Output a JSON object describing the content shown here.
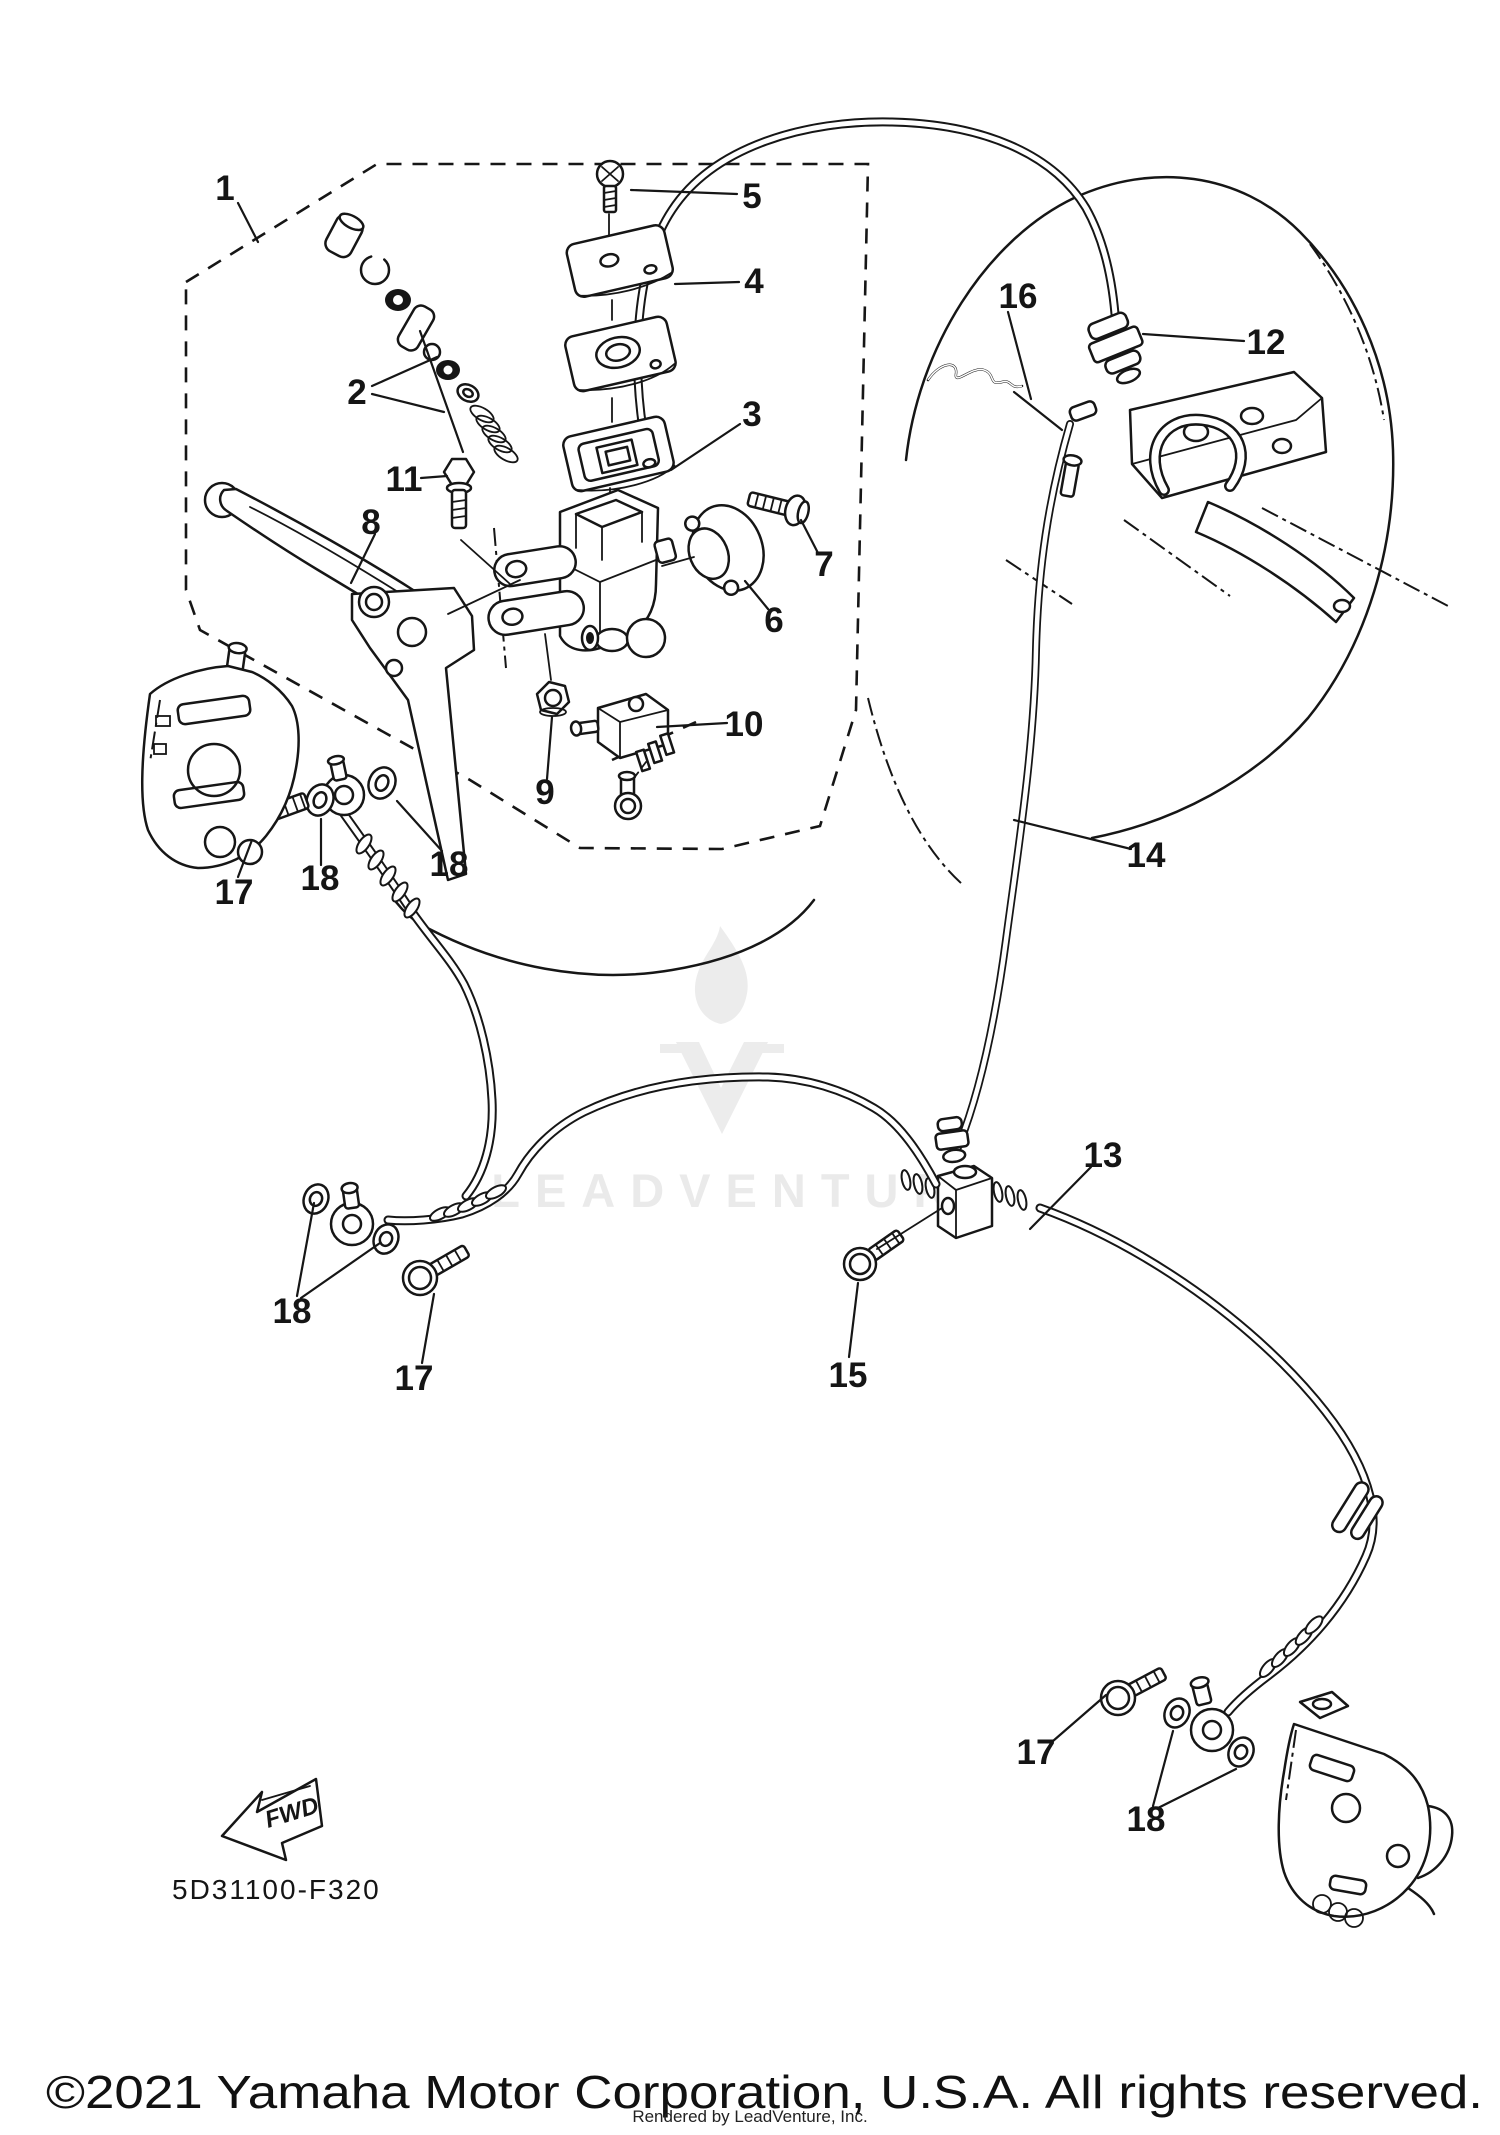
{
  "page": {
    "background": "#ffffff",
    "line_color": "#161616",
    "watermark_color": "#eaeaea"
  },
  "document": {
    "part_code": "5D31100-F320",
    "copyright": "©2021 Yamaha Motor Corporation, U.S.A. All rights reserved.",
    "rendered_by": "Rendered by LeadVenture, Inc.",
    "fwd_label": "FWD",
    "watermark_text": "LEADVENTURE"
  },
  "diagram": {
    "callouts": [
      {
        "id": "callout-1",
        "label": "1",
        "x": 225,
        "y": 200
      },
      {
        "id": "callout-2",
        "label": "2",
        "x": 357,
        "y": 404
      },
      {
        "id": "callout-3",
        "label": "3",
        "x": 752,
        "y": 426
      },
      {
        "id": "callout-4",
        "label": "4",
        "x": 754,
        "y": 293
      },
      {
        "id": "callout-5",
        "label": "5",
        "x": 752,
        "y": 208
      },
      {
        "id": "callout-6",
        "label": "6",
        "x": 774,
        "y": 632
      },
      {
        "id": "callout-7",
        "label": "7",
        "x": 824,
        "y": 576
      },
      {
        "id": "callout-8",
        "label": "8",
        "x": 371,
        "y": 534
      },
      {
        "id": "callout-9",
        "label": "9",
        "x": 545,
        "y": 804
      },
      {
        "id": "callout-10",
        "label": "10",
        "x": 744,
        "y": 736
      },
      {
        "id": "callout-11",
        "label": "11",
        "x": 404,
        "y": 491
      },
      {
        "id": "callout-12",
        "label": "12",
        "x": 1266,
        "y": 354
      },
      {
        "id": "callout-13",
        "label": "13",
        "x": 1103,
        "y": 1167
      },
      {
        "id": "callout-14",
        "label": "14",
        "x": 1146,
        "y": 867
      },
      {
        "id": "callout-15",
        "label": "15",
        "x": 848,
        "y": 1387
      },
      {
        "id": "callout-16",
        "label": "16",
        "x": 1018,
        "y": 308
      },
      {
        "id": "callout-17a",
        "label": "17",
        "x": 234,
        "y": 904
      },
      {
        "id": "callout-17b",
        "label": "17",
        "x": 414,
        "y": 1390
      },
      {
        "id": "callout-17c",
        "label": "17",
        "x": 1036,
        "y": 1764
      },
      {
        "id": "callout-18a",
        "label": "18",
        "x": 320,
        "y": 890
      },
      {
        "id": "callout-18b",
        "label": "18",
        "x": 449,
        "y": 876
      },
      {
        "id": "callout-18c",
        "label": "18",
        "x": 292,
        "y": 1323
      },
      {
        "id": "callout-18d",
        "label": "18",
        "x": 1146,
        "y": 1831
      }
    ]
  }
}
